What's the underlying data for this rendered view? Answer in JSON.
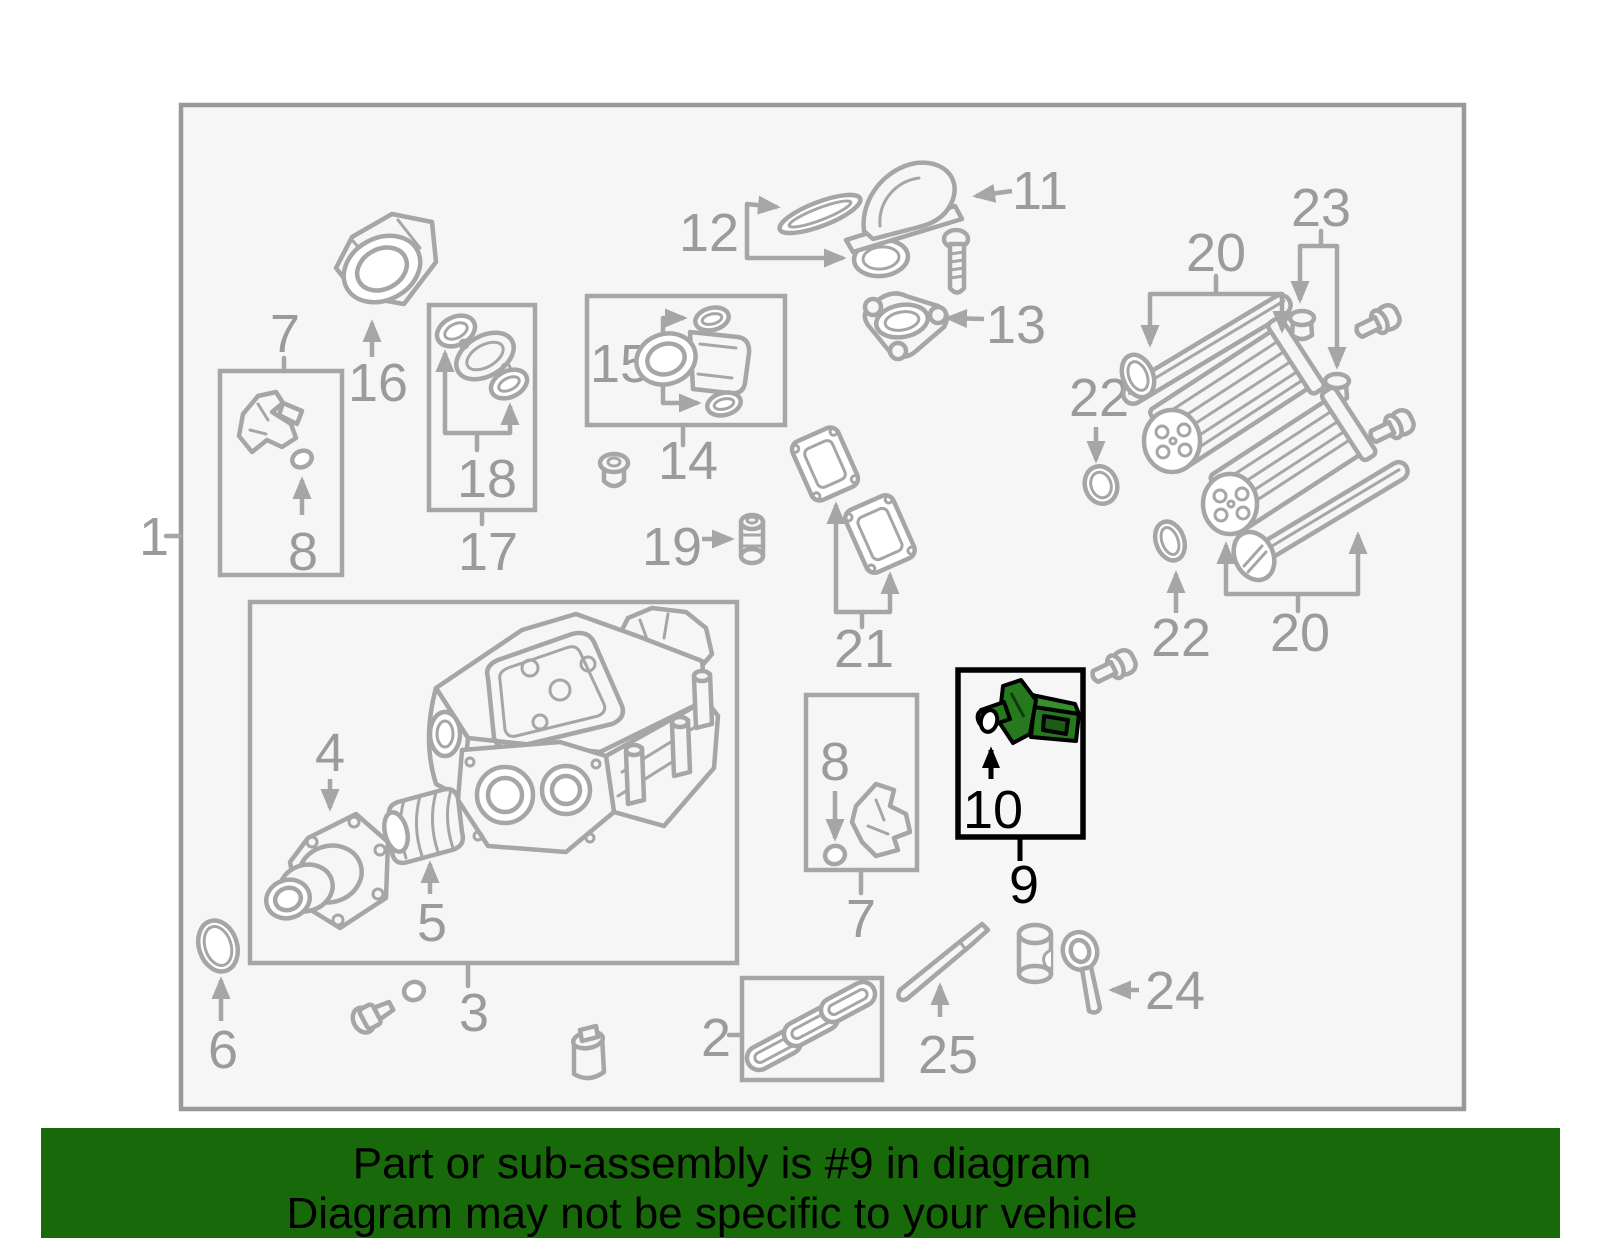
{
  "banner": {
    "line1": "Part or sub-assembly is #9 in diagram",
    "line2": "Diagram may not be specific to your vehicle"
  },
  "highlight": {
    "main_callout": "9",
    "sub_callout": "10"
  },
  "callouts": {
    "c1": "1",
    "c2": "2",
    "c3": "3",
    "c4": "4",
    "c5": "5",
    "c6": "6",
    "c7a": "7",
    "c7b": "7",
    "c8a": "8",
    "c8b": "8",
    "c9": "9",
    "c10": "10",
    "c11": "11",
    "c12": "12",
    "c13": "13",
    "c14": "14",
    "c15": "15",
    "c16": "16",
    "c17": "17",
    "c18": "18",
    "c19": "19",
    "c20a": "20",
    "c20b": "20",
    "c21": "21",
    "c22a": "22",
    "c22b": "22",
    "c23": "23",
    "c24": "24",
    "c25": "25"
  },
  "colors": {
    "page_bg": "#ffffff",
    "diagram_bg": "#f6f6f6",
    "border": "#999999",
    "line": "#a6a6a6",
    "label": "#9b9b9b",
    "banner_bg": "#176909",
    "banner_text": "#000000",
    "highlight_part": "#27791e",
    "highlight_part_light": "#35912a",
    "highlight_part_dark": "#1c5c15",
    "highlight_outline": "#000000"
  }
}
